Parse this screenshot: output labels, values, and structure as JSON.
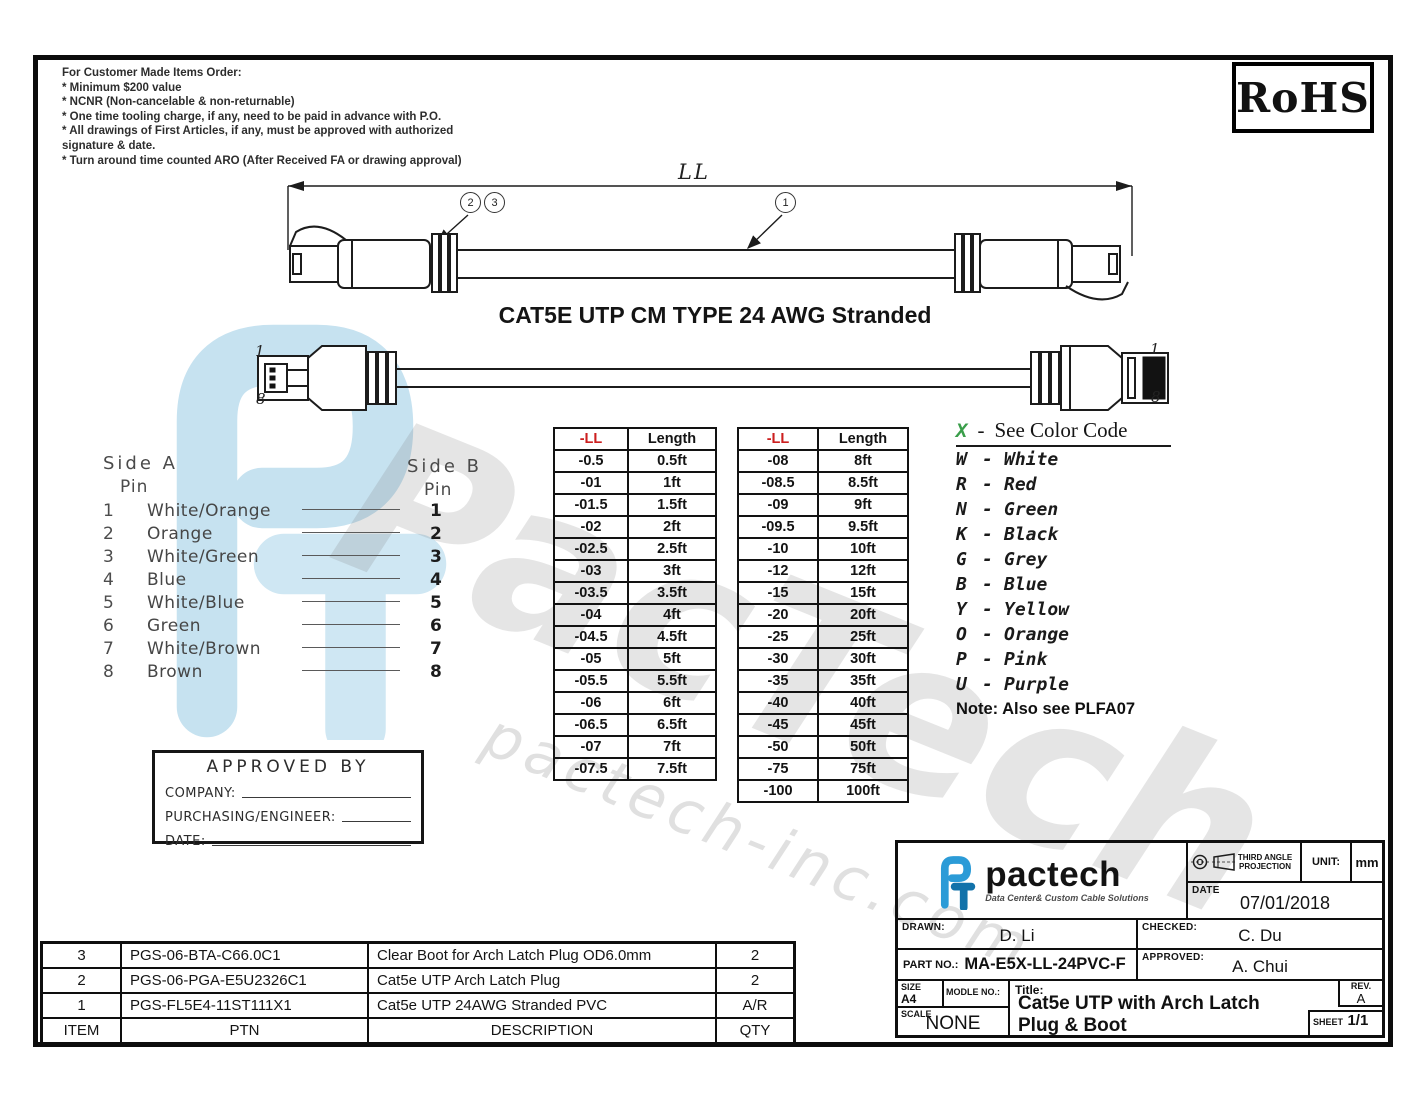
{
  "notes": {
    "title": "For Customer Made Items Order:",
    "lines": [
      "* Minimum $200 value",
      "* NCNR (Non-cancelable & non-returnable)",
      "* One time tooling charge, if any, need to be paid in advance with P.O.",
      "* All drawings of First Articles, if any, must be approved with authorized",
      "  signature & date.",
      "* Turn around time counted ARO (After Received FA or drawing approval)"
    ]
  },
  "rohs_label": "RoHS",
  "drawing": {
    "dim_label": "LL",
    "callouts": {
      "left_a": "2",
      "left_b": "3",
      "mid": "1"
    },
    "cable_title": "CAT5E UTP CM TYPE 24 AWG Stranded",
    "pin_top": "1",
    "pin_bottom": "8"
  },
  "pinout": {
    "side_a_title": "Side A",
    "side_b_title": "Side B",
    "pin_word": "Pin",
    "rows": [
      {
        "pin": "1",
        "color": "White/Orange",
        "b": "1"
      },
      {
        "pin": "2",
        "color": "Orange",
        "b": "2"
      },
      {
        "pin": "3",
        "color": "White/Green",
        "b": "3"
      },
      {
        "pin": "4",
        "color": "Blue",
        "b": "4"
      },
      {
        "pin": "5",
        "color": "White/Blue",
        "b": "5"
      },
      {
        "pin": "6",
        "color": "Green",
        "b": "6"
      },
      {
        "pin": "7",
        "color": "White/Brown",
        "b": "7"
      },
      {
        "pin": "8",
        "color": "Brown",
        "b": "8"
      }
    ]
  },
  "length_tables": [
    {
      "headers": [
        "-LL",
        "Length"
      ],
      "rows": [
        [
          "-0.5",
          "0.5ft"
        ],
        [
          "-01",
          "1ft"
        ],
        [
          "-01.5",
          "1.5ft"
        ],
        [
          "-02",
          "2ft"
        ],
        [
          "-02.5",
          "2.5ft"
        ],
        [
          "-03",
          "3ft"
        ],
        [
          "-03.5",
          "3.5ft"
        ],
        [
          "-04",
          "4ft"
        ],
        [
          "-04.5",
          "4.5ft"
        ],
        [
          "-05",
          "5ft"
        ],
        [
          "-05.5",
          "5.5ft"
        ],
        [
          "-06",
          "6ft"
        ],
        [
          "-06.5",
          "6.5ft"
        ],
        [
          "-07",
          "7ft"
        ],
        [
          "-07.5",
          "7.5ft"
        ]
      ]
    },
    {
      "headers": [
        "-LL",
        "Length"
      ],
      "rows": [
        [
          "-08",
          "8ft"
        ],
        [
          "-08.5",
          "8.5ft"
        ],
        [
          "-09",
          "9ft"
        ],
        [
          "-09.5",
          "9.5ft"
        ],
        [
          "-10",
          "10ft"
        ],
        [
          "-12",
          "12ft"
        ],
        [
          "-15",
          "15ft"
        ],
        [
          "-20",
          "20ft"
        ],
        [
          "-25",
          "25ft"
        ],
        [
          "-30",
          "30ft"
        ],
        [
          "-35",
          "35ft"
        ],
        [
          "-40",
          "40ft"
        ],
        [
          "-45",
          "45ft"
        ],
        [
          "-50",
          "50ft"
        ],
        [
          "-75",
          "75ft"
        ],
        [
          "-100",
          "100ft"
        ]
      ]
    }
  ],
  "color_code": {
    "heading_letter": "X",
    "heading_dash": "-",
    "heading_text": "See Color Code",
    "entries": [
      {
        "letter": "W",
        "name": "White"
      },
      {
        "letter": "R",
        "name": "Red"
      },
      {
        "letter": "N",
        "name": "Green"
      },
      {
        "letter": "K",
        "name": "Black"
      },
      {
        "letter": "G",
        "name": "Grey"
      },
      {
        "letter": "B",
        "name": "Blue"
      },
      {
        "letter": "Y",
        "name": "Yellow"
      },
      {
        "letter": "O",
        "name": "Orange"
      },
      {
        "letter": "P",
        "name": "Pink"
      },
      {
        "letter": "U",
        "name": "Purple"
      }
    ],
    "note": "Note: Also see PLFA07"
  },
  "approval_box": {
    "title": "APPROVED BY",
    "company_label": "COMPANY:",
    "purchasing_label": "PURCHASING/ENGINEER:",
    "date_label": "DATE:"
  },
  "bom": {
    "headers": [
      "ITEM",
      "PTN",
      "DESCRIPTION",
      "QTY"
    ],
    "rows": [
      [
        "3",
        "PGS-06-BTA-C66.0C1",
        "Clear Boot for Arch Latch Plug OD6.0mm",
        "2"
      ],
      [
        "2",
        "PGS-06-PGA-E5U2326C1",
        "Cat5e UTP Arch Latch Plug",
        "2"
      ],
      [
        "1",
        "PGS-FL5E4-11ST111X1",
        "Cat5e UTP 24AWG Stranded PVC",
        "A/R"
      ]
    ]
  },
  "title_block": {
    "brand": "pactech",
    "brand_tagline": "Data Center& Custom Cable Solutions",
    "projection_label": "THIRD ANGLE PROJECTION",
    "unit_label": "UNIT:",
    "unit_value": "mm",
    "date_label": "DATE",
    "date_value": "07/01/2018",
    "drawn_label": "DRAWN:",
    "drawn_value": "D. Li",
    "checked_label": "CHECKED:",
    "checked_value": "C. Du",
    "part_no_label": "PART NO.:",
    "part_no_value": "MA-E5X-LL-24PVC-F",
    "approved_label": "APPROVED:",
    "approved_value": "A. Chui",
    "size_label": "SIZE",
    "size_value": "A4",
    "module_label": "MODLE NO.:",
    "title_label": "Title:",
    "title_value": "Cat5e UTP with Arch Latch Plug & Boot",
    "scale_label": "SCALE",
    "scale_value": "NONE",
    "rev_label": "REV.",
    "rev_value": "A",
    "sheet_label": "SHEET",
    "sheet_value": "1/1"
  },
  "watermark": {
    "text_large": "PacTech",
    "text_small": "pactech-inc.com"
  },
  "colors": {
    "brand_blue_light": "#2b9bd7",
    "brand_blue_dark": "#1272aa",
    "watermark_blue": "#c6e2f0",
    "table_header_red": "#cc1f1f",
    "color_code_green": "#3a9e4a"
  }
}
